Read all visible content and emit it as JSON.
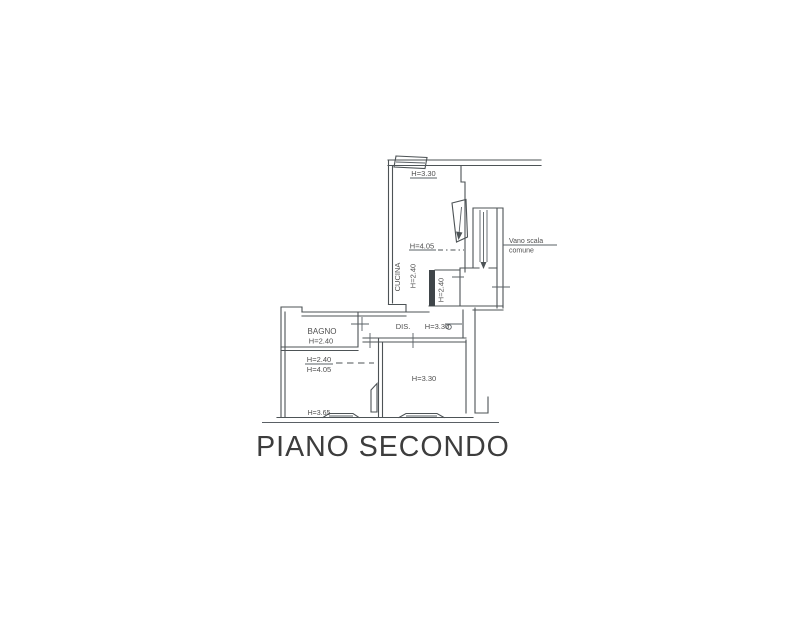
{
  "title": "PIANO SECONDO",
  "colors": {
    "background": "#ffffff",
    "line": "#4d5356",
    "text": "#4f4f4f",
    "title_text": "#3d3d3d",
    "wall_fill": "#3f4549"
  },
  "plan": {
    "labels": {
      "kitchen_top_height": "H=3.30",
      "kitchen_mid_height": "H=4.05",
      "kitchen_name": "CUCINA",
      "kitchen_height": "H=2.40",
      "niche_height": "H=2.40",
      "stairwell_line1": "Vano scala",
      "stairwell_line2": "comune",
      "hall_name": "DIS.",
      "hall_height": "H=3.30",
      "bath_name": "BAGNO",
      "bath_height": "H=2.40",
      "room_left_height_a": "H=2.40",
      "room_left_height_b": "H=4.05",
      "room_left_height_c": "H=3.65",
      "room_right_height": "H=3.30"
    }
  }
}
